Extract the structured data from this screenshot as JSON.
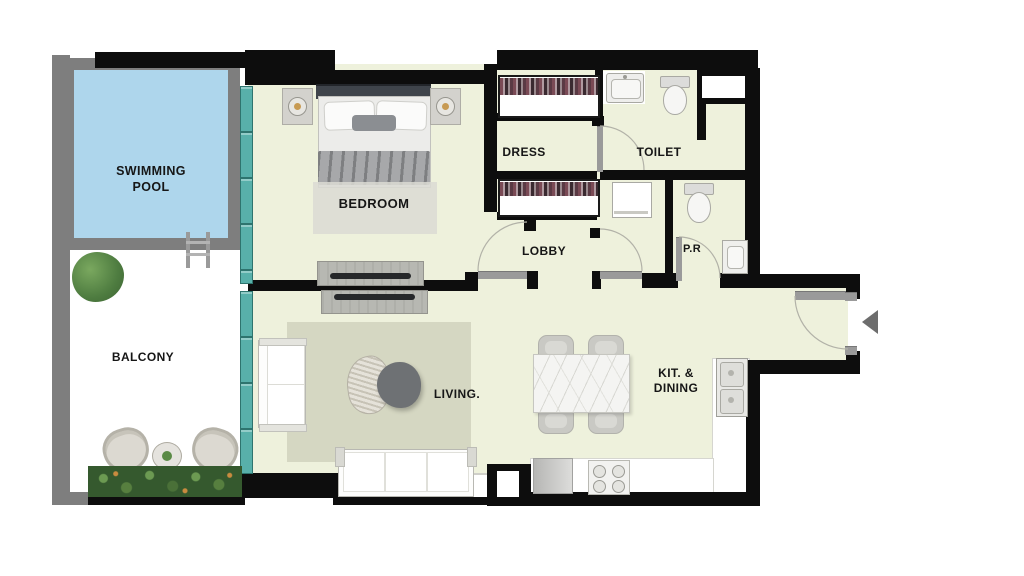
{
  "palette": {
    "wall": "#0d0d0d",
    "gwall": "#7e7e7e",
    "floor": "#eef1dc",
    "pool": "#aed6ec",
    "glass": "#58b0aa",
    "rug": "#d5d7c2",
    "green": "#35592e",
    "thresh": "#9a9a9a",
    "arrow": "#6d6d6d"
  },
  "labels": {
    "swimming_pool": "SWIMMING\nPOOL",
    "balcony": "BALCONY",
    "bedroom": "BEDROOM",
    "dress": "DRESS",
    "toilet": "TOILET",
    "lobby": "LOBBY",
    "powder_room": "P.R",
    "living": "LIVING.",
    "kitchen_dining": "KIT. &\nDINING"
  },
  "icons": {
    "entry_arrow": "left-facing-triangle"
  }
}
